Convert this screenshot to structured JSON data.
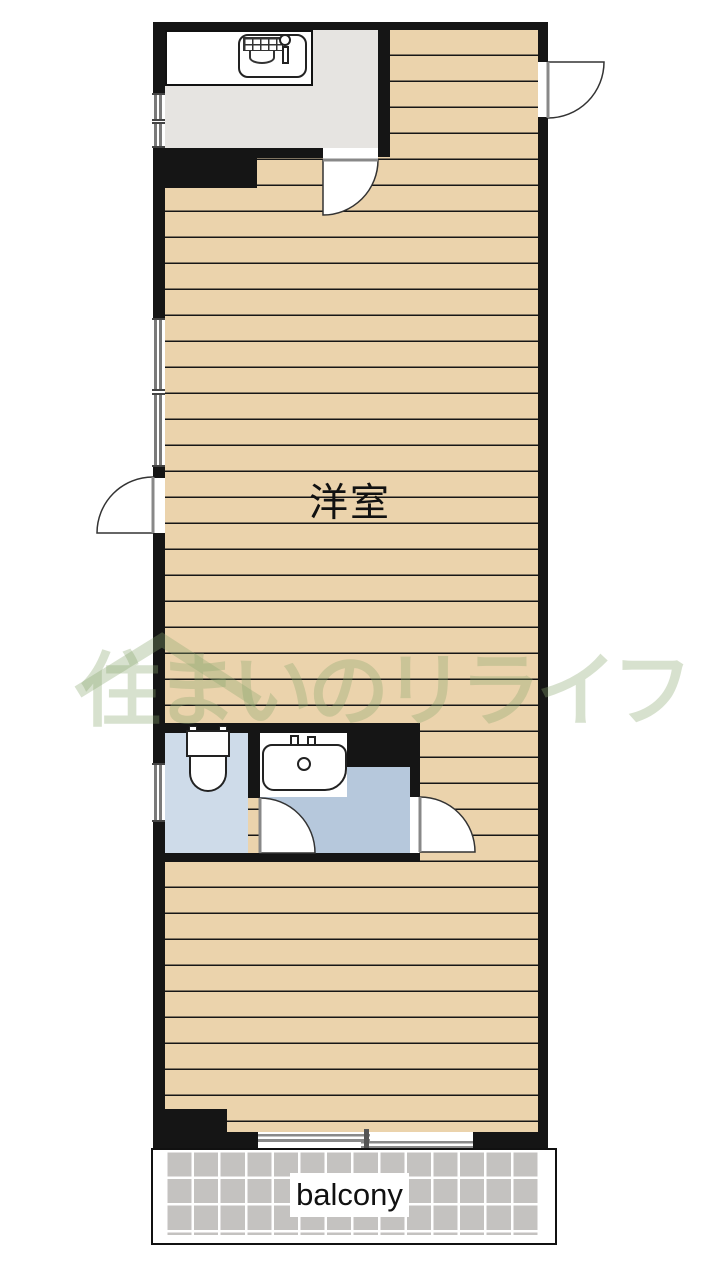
{
  "plan": {
    "title": "apartment-floorplan",
    "rooms": {
      "main_room": {
        "label": "洋室"
      },
      "kitchen": {
        "label": ""
      },
      "toilet": {
        "label": ""
      },
      "washroom": {
        "label": ""
      },
      "balcony": {
        "label": "balcony"
      }
    },
    "watermark": {
      "text": "住まいのリライフ"
    },
    "icons": {
      "kitchen_sink": "kitchen-sink-icon",
      "toilet": "toilet-icon",
      "washbasin": "washbasin-icon",
      "roof": "roof-icon"
    },
    "colors": {
      "wall": "#151515",
      "floor_tan": "#ebd3ac",
      "floor_stripe": "#161616",
      "kitchen_gray": "#e6e4e1",
      "toilet_blue": "#cedbe9",
      "washroom_blue": "#b6c8dc",
      "balcony_tile": "#c4c2c0",
      "watermark_green": "rgba(139,167,111,0.34)"
    }
  }
}
